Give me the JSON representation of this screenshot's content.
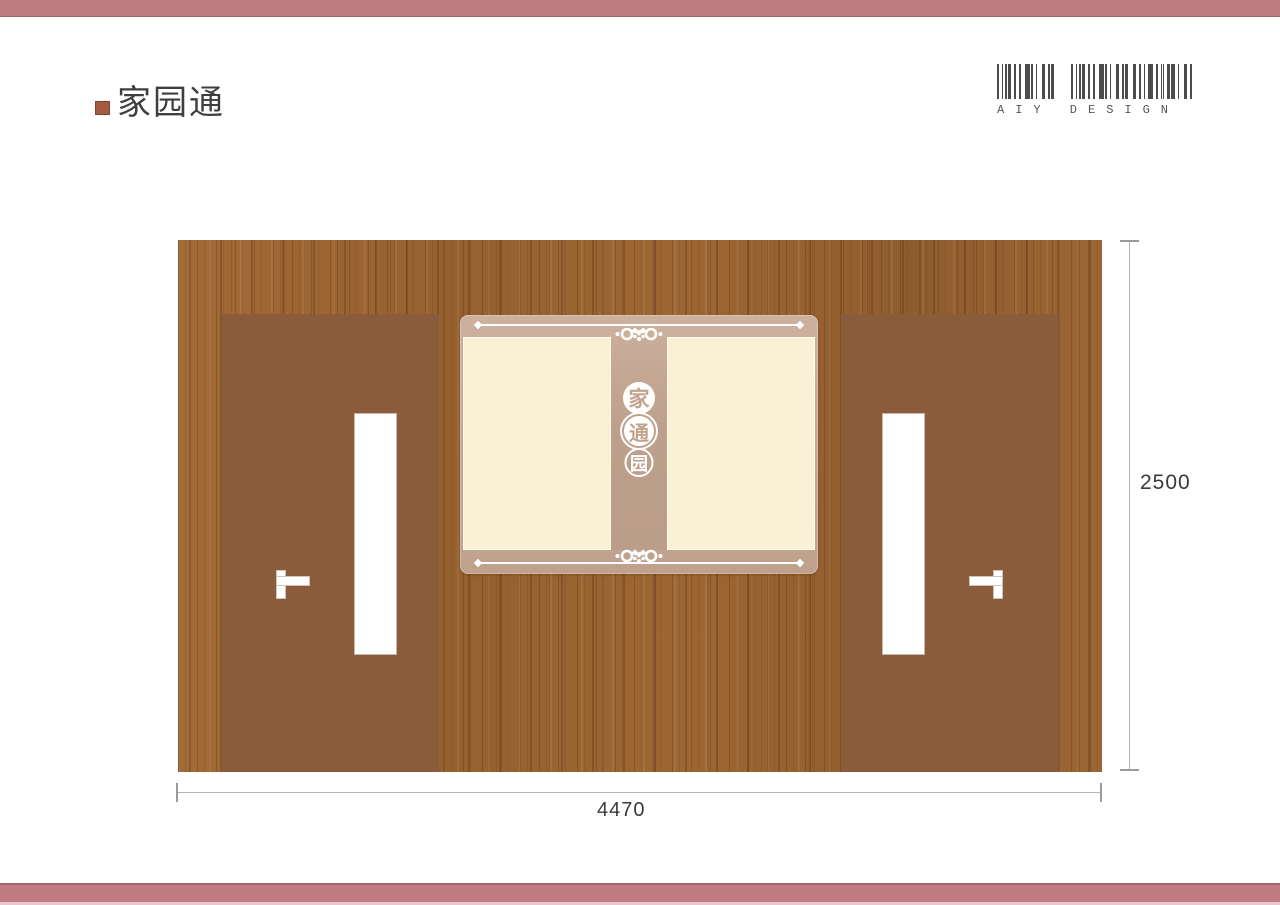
{
  "header": {
    "title": "家园通"
  },
  "brand": {
    "label": "AIY DESIGN"
  },
  "board": {
    "char_top": "家",
    "char_middle": "通",
    "char_bottom": "园"
  },
  "dimensions": {
    "height": "2500",
    "width": "4470"
  },
  "colors": {
    "accent_pink": "#c17b83",
    "accent_pink_dark": "#a5606a",
    "bullet_brown": "#a35c41",
    "wood_base": "#9a6433",
    "door_brown": "#8a5c3b",
    "board_tan": "#c3a692",
    "panel_cream": "#faf0d6",
    "dimension_line": "#b5b5b5",
    "barcode_gray": "#4c4c4c"
  }
}
